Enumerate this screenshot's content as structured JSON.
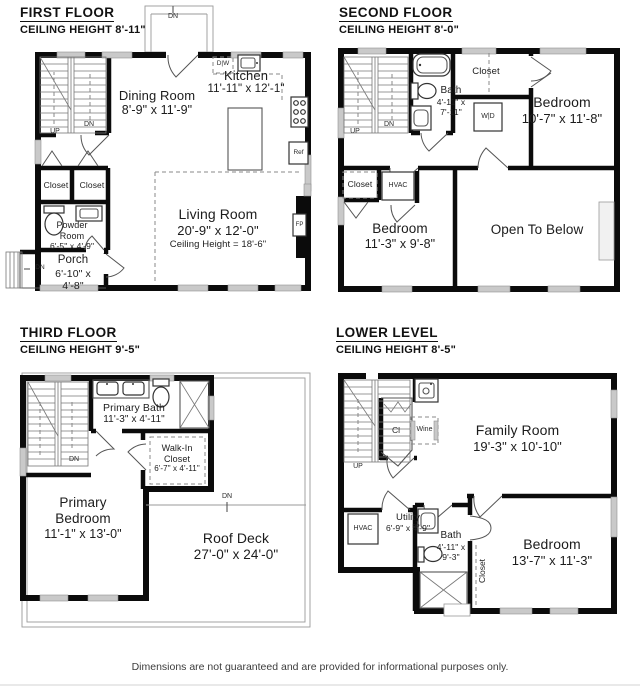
{
  "footer": {
    "disclaimer": "Dimensions are not guaranteed and are provided for informational purposes only."
  },
  "floors": {
    "first": {
      "title": "FIRST FLOOR",
      "ceiling": "CEILING HEIGHT 8'-11\"",
      "rooms": {
        "dining": {
          "name": "Dining Room",
          "dims": "8'-9\" x 11'-9\""
        },
        "kitchen": {
          "name": "Kitchen",
          "dims": "11'-11\" x 12'-1\""
        },
        "living": {
          "name": "Living Room",
          "dims": "20'-9\" x 12'-0\"",
          "note": "Ceiling Height = 18'-6\""
        },
        "powder": {
          "name": "Powder Room",
          "dims": "6'-5\" x 4'-9\""
        },
        "porch": {
          "name": "Porch",
          "dims": "6'-10\" x 4'-8\""
        },
        "closet_a": {
          "name": "Closet"
        },
        "closet_b": {
          "name": "Closet"
        }
      },
      "tags": {
        "dn_entry": "DN",
        "up": "UP",
        "dn": "DN",
        "dn_porch": "DN",
        "dishwasher": "D|W",
        "fridge": "Ref",
        "fireplace": "FP"
      }
    },
    "second": {
      "title": "SECOND FLOOR",
      "ceiling": "CEILING HEIGHT 8'-0\"",
      "rooms": {
        "bath": {
          "name": "Bath",
          "dims": "4'-11\" x 7'-11\""
        },
        "closet_top": {
          "name": "Closet"
        },
        "bedroom_right": {
          "name": "Bedroom",
          "dims": "10'-7\" x 11'-8\""
        },
        "closet_left": {
          "name": "Closet"
        },
        "bedroom_left": {
          "name": "Bedroom",
          "dims": "11'-3\" x 9'-8\""
        },
        "open_below": {
          "name": "Open To Below"
        }
      },
      "tags": {
        "up": "UP",
        "dn": "DN",
        "washer_dryer": "W|D",
        "hvac": "HVAC"
      }
    },
    "third": {
      "title": "THIRD FLOOR",
      "ceiling": "CEILING HEIGHT 9'-5\"",
      "rooms": {
        "primary_bath": {
          "name": "Primary Bath",
          "dims": "11'-3\" x 4'-11\""
        },
        "walkin_closet": {
          "name": "Walk-In Closet",
          "dims": "6'-7\" x 4'-11\""
        },
        "primary_bedroom": {
          "name": "Primary Bedroom",
          "dims": "11'-1\" x 13'-0\""
        },
        "roof_deck": {
          "name": "Roof Deck",
          "dims": "27'-0\" x 24'-0\""
        }
      },
      "tags": {
        "dn": "DN",
        "dn_deck": "DN"
      }
    },
    "lower": {
      "title": "LOWER LEVEL",
      "ceiling": "CEILING HEIGHT 8'-5\"",
      "rooms": {
        "family": {
          "name": "Family Room",
          "dims": "19'-3\" x 10'-10\""
        },
        "utility": {
          "name": "Utility",
          "dims": "6'-9\" x 4'-9\""
        },
        "bath": {
          "name": "Bath",
          "dims": "4'-11\" x 9'-3\""
        },
        "closet": {
          "name": "Closet"
        },
        "bedroom": {
          "name": "Bedroom",
          "dims": "13'-7\" x 11'-3\""
        }
      },
      "tags": {
        "up": "UP",
        "closet_small": "Cl",
        "wine": "Wine",
        "hvac": "HVAC",
        "electrical": "EP"
      }
    }
  }
}
